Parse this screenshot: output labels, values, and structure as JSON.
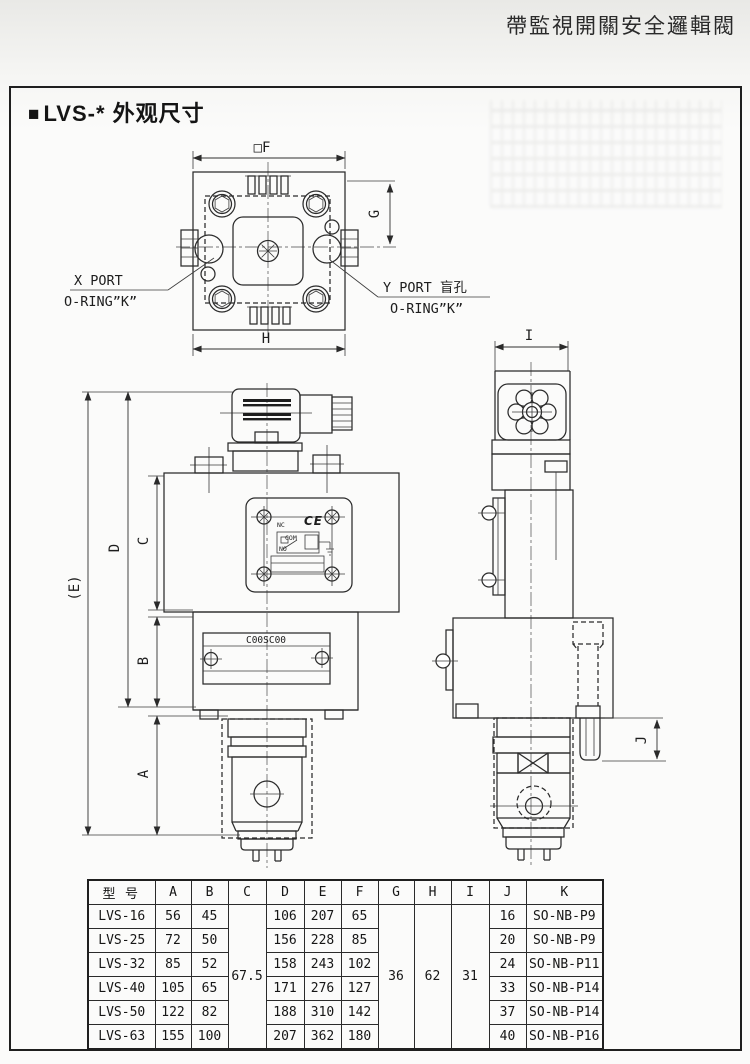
{
  "page": {
    "header_title": "帶監視開關安全邏輯閥",
    "section_title_marker": "■",
    "section_title": "LVS-* 外观尺寸"
  },
  "drawing": {
    "dims": {
      "f": "□F",
      "g": "G",
      "h": "H",
      "i": "I",
      "c": "C",
      "d": "D",
      "e": "(E)",
      "b": "B",
      "a": "A",
      "j": "J"
    },
    "ports": {
      "x_line1": "X PORT",
      "x_line2": "O-RING”K”",
      "y_line1": "Y PORT 盲孔",
      "y_line2": "O-RING”K”"
    },
    "nameplate": {
      "nc": "NC",
      "com": "COM",
      "no": "NO",
      "ce": "CE"
    },
    "brand_label": "C00SC00"
  },
  "table": {
    "headers": [
      "型 号",
      "A",
      "B",
      "C",
      "D",
      "E",
      "F",
      "G",
      "H",
      "I",
      "J",
      "K"
    ],
    "merged": {
      "c": "67.5",
      "g": "36",
      "h": "62",
      "i": "31"
    },
    "rows": [
      {
        "model": "LVS-16",
        "a": "56",
        "b": "45",
        "d": "106",
        "e": "207",
        "f": "65",
        "j": "16",
        "k": "SO-NB-P9"
      },
      {
        "model": "LVS-25",
        "a": "72",
        "b": "50",
        "d": "156",
        "e": "228",
        "f": "85",
        "j": "20",
        "k": "SO-NB-P9"
      },
      {
        "model": "LVS-32",
        "a": "85",
        "b": "52",
        "d": "158",
        "e": "243",
        "f": "102",
        "j": "24",
        "k": "SO-NB-P11"
      },
      {
        "model": "LVS-40",
        "a": "105",
        "b": "65",
        "d": "171",
        "e": "276",
        "f": "127",
        "j": "33",
        "k": "SO-NB-P14"
      },
      {
        "model": "LVS-50",
        "a": "122",
        "b": "82",
        "d": "188",
        "e": "310",
        "f": "142",
        "j": "37",
        "k": "SO-NB-P14"
      },
      {
        "model": "LVS-63",
        "a": "155",
        "b": "100",
        "d": "207",
        "e": "362",
        "f": "180",
        "j": "40",
        "k": "SO-NB-P16"
      }
    ]
  }
}
